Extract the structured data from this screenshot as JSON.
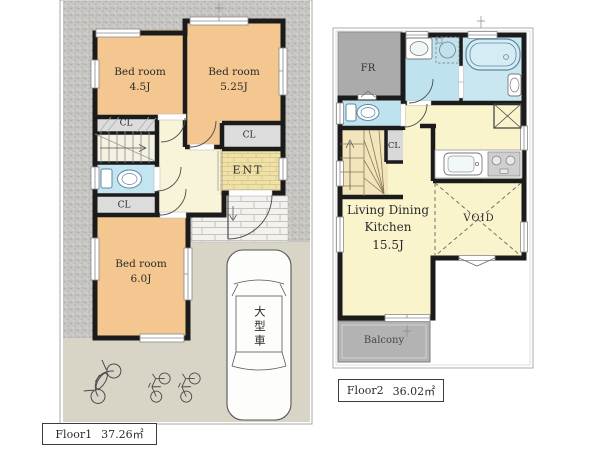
{
  "colors": {
    "wall": "#1b1b1b",
    "bedroom_tan": "#f3c78f",
    "ldk_yellow": "#f9f4cb",
    "sanitary_blue": "#bfe2ef",
    "closet_gray": "#dcdcdc",
    "balcony_gray": "#b3b3b3",
    "site_concrete": "#c7c6c2",
    "driveway_beige": "#d8d4c6"
  },
  "floor1": {
    "name": "Floor1",
    "area": "37.26㎡",
    "bedroom1": {
      "name": "Bed room",
      "size": "4.5J"
    },
    "bedroom2": {
      "name": "Bed room",
      "size": "5.25J"
    },
    "bedroom3": {
      "name": "Bed room",
      "size": "6.0J"
    },
    "closet1": "CL",
    "closet2": "CL",
    "closet3": "CL",
    "entrance": "ENT",
    "car_space": "大型車"
  },
  "floor2": {
    "name": "Floor2",
    "area": "36.02㎡",
    "free_room": "FR",
    "closet": "CL",
    "ldk": {
      "name_line1": "Living Dining",
      "name_line2": "Kitchen",
      "size": "15.5J"
    },
    "void": "VOID",
    "balcony": "Balcony"
  }
}
